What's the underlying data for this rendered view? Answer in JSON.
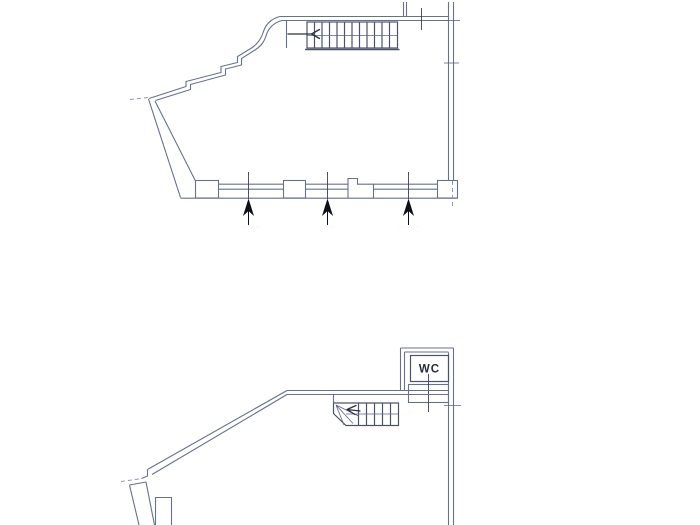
{
  "upper_plan": {
    "description_label": "upper floor plan",
    "staircase": {
      "arrow_direction": "left"
    },
    "entrance_arrows": [
      {
        "label": "· ··· ·····"
      },
      {
        "label": "·· ····"
      },
      {
        "label": "···· ·····"
      }
    ]
  },
  "lower_plan": {
    "description_label": "lower floor plan",
    "wc_label": "WC",
    "staircase": {
      "arrow_direction": "left"
    }
  },
  "colors": {
    "background": "#ffffff",
    "wall_line": "#66718c",
    "dark_line": "#49536d",
    "arrow_black": "#0e1118",
    "dashed_line": "#8d96ab",
    "faint_label": "#c7cbd7"
  }
}
